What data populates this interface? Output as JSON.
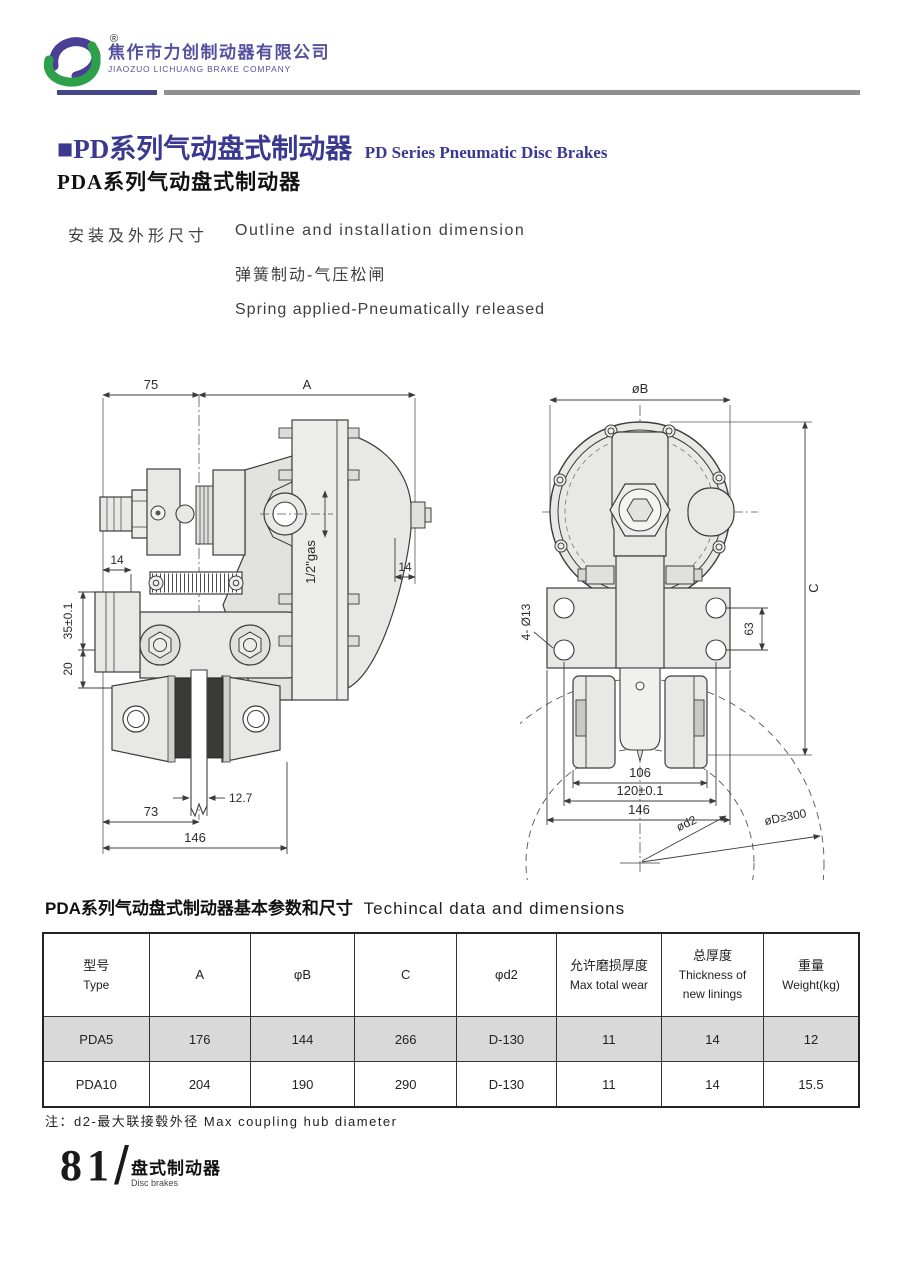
{
  "header": {
    "company_cn": "焦作市力创制动器有限公司",
    "company_en": "JIAOZUO LICHUANG BRAKE COMPANY",
    "registered_mark": "®"
  },
  "title": {
    "main_cn": "■PD系列气动盘式制动器",
    "main_en": "PD Series Pneumatic Disc Brakes",
    "sub_cn": "PDA系列气动盘式制动器"
  },
  "intro": {
    "label_cn": "安装及外形尺寸",
    "line1_en": "Outline and installation dimension",
    "line2_cn": "弹簧制动-气压松闸",
    "line3_en": "Spring applied-Pneumatically released"
  },
  "drawings": {
    "side_view": {
      "dim_75": "75",
      "dim_A": "A",
      "dim_14_left": "14",
      "dim_14_right": "14",
      "dim_gas": "1/2\"gas",
      "dim_35": "35±0.1",
      "dim_20": "20",
      "dim_12_7": "12.7",
      "dim_73": "73",
      "dim_146": "146"
    },
    "front_view": {
      "dim_B": "øB",
      "dim_C": "C",
      "dim_holes": "4- Ø13",
      "dim_63": "63",
      "dim_106": "106",
      "dim_120": "120±0.1",
      "dim_146": "146",
      "dim_d2": "ød2",
      "dim_D300": "øD≥300"
    }
  },
  "table": {
    "title_cn": "PDA系列气动盘式制动器基本参数和尺寸",
    "title_en": "Techincal data and dimensions",
    "columns": [
      {
        "line1": "型号",
        "line2": "Type"
      },
      {
        "line1": "A"
      },
      {
        "line1": "φB"
      },
      {
        "line1": "C"
      },
      {
        "line1": "φd2"
      },
      {
        "line1": "允许磨损厚度",
        "line2": "Max total wear"
      },
      {
        "line1": "总厚度",
        "line2": "Thickness of",
        "line3": "new linings"
      },
      {
        "line1": "重量",
        "line2": "Weight(kg)"
      }
    ],
    "rows": [
      {
        "type": "PDA5",
        "a": "176",
        "b": "144",
        "c": "266",
        "d2": "D-130",
        "wear": "11",
        "thickness": "14",
        "weight": "12"
      },
      {
        "type": "PDA10",
        "a": "204",
        "b": "190",
        "c": "290",
        "d2": "D-130",
        "wear": "11",
        "thickness": "14",
        "weight": "15.5"
      }
    ]
  },
  "note": "注：d2-最大联接毂外径  Max coupling hub diameter",
  "footer": {
    "page_number": "81",
    "section_cn": "盘式制动器",
    "section_en": "Disc brakes"
  },
  "colors": {
    "brand_purple": "#4a3f94",
    "brand_green": "#2fa04a",
    "title_navy": "#3b3890",
    "rule_gray": "#8f8f8f",
    "row_shade": "#d9d9d9"
  }
}
